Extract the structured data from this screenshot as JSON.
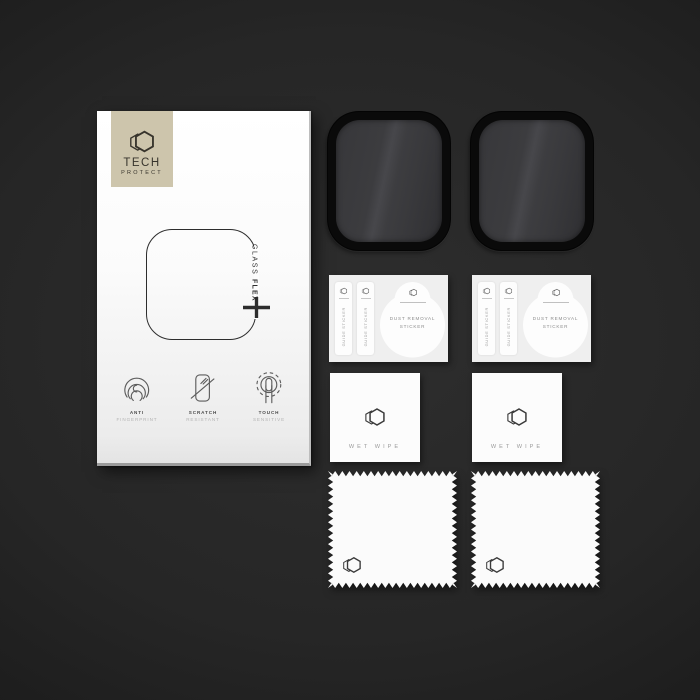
{
  "scene": {
    "description": "TECH PROTECT Glass Flex smartwatch screen protector retail kit on dark background",
    "bg_center_color": "#2e2e2e",
    "bg_edge_color": "#141414"
  },
  "box": {
    "badge_color": "#cdc5ac",
    "brand_top": "TECH",
    "brand_bottom": "PROTECT",
    "product_line1": "GLASS",
    "product_line2": "FLEX",
    "plus_sign": "+",
    "features": [
      {
        "top": "ANTI",
        "bottom": "FINGERPRINT"
      },
      {
        "top": "SCRATCH",
        "bottom": "RESISTANT"
      },
      {
        "top": "TOUCH",
        "bottom": "SENSITIVE"
      }
    ]
  },
  "protectors": {
    "count": 2,
    "frame_color": "#0a0a0a",
    "glass_color": "#3c3c3f"
  },
  "sticker_cards": [
    {
      "strips": [
        {
          "label": "GUIDE STICKER"
        },
        {
          "label": "GUIDE STICKER"
        }
      ],
      "dust": {
        "line1": "DUST REMOVAL",
        "line2": "STICKER"
      }
    },
    {
      "strips": [
        {
          "label": "GUIDE STICKER"
        },
        {
          "label": "GUIDE STICKER"
        }
      ],
      "dust": {
        "line1": "DUST REMOVAL",
        "line2": "STICKER"
      }
    }
  ],
  "wet_wipes": [
    {
      "label": "WET WIPE"
    },
    {
      "label": "WET WIPE"
    }
  ],
  "cloths": {
    "count": 2
  }
}
